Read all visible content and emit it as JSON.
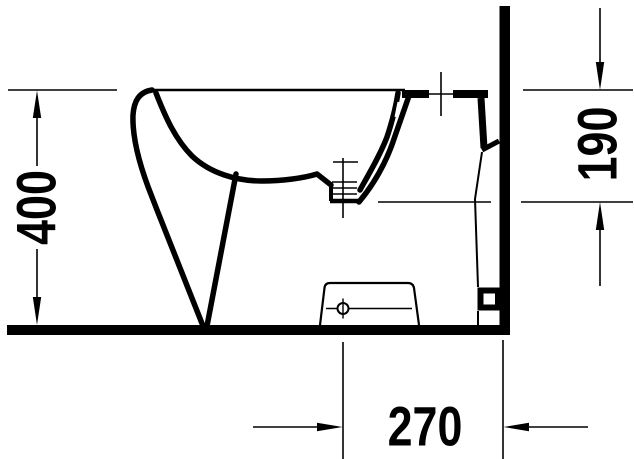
{
  "drawing": {
    "subject": "floor-standing bidet — side elevation",
    "style": "monochrome technical line drawing",
    "colors": {
      "line": "#000000",
      "background": "#ffffff"
    },
    "dimensions": [
      {
        "id": "overall-height",
        "label": "400",
        "orientation": "vertical",
        "position": "left"
      },
      {
        "id": "rim-to-outlet-height",
        "label": "190",
        "orientation": "vertical",
        "position": "right"
      },
      {
        "id": "outlet-to-wall-distance",
        "label": "270",
        "orientation": "horizontal",
        "position": "bottom"
      }
    ]
  }
}
